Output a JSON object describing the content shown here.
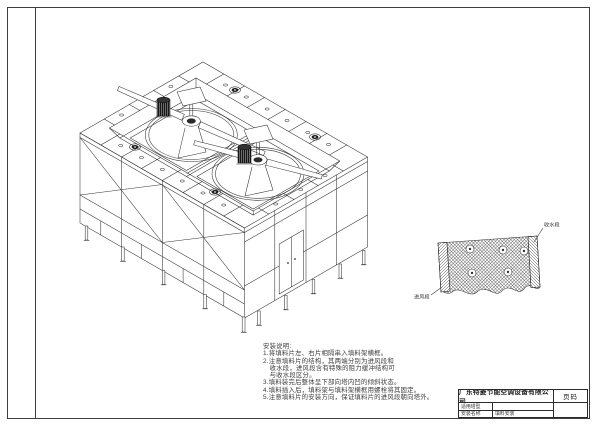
{
  "sheet": {
    "paper_color": "#ffffff",
    "ink_color": "#333333"
  },
  "notes": {
    "title": "安装说明:",
    "lines": [
      "1.将填料片左、右片相隔串入填料架横框。",
      "2.注意填料片的结构，其两端分别为进风段和",
      "　收水段，进风段含有特殊的阻力缓冲结构可",
      "　与收水段区分。",
      "3.填料装完后整体呈下部向塔内凹的倾斜状态。",
      "4.填料插入后，填料架与填料架横框用螺栓将其固定。",
      "5.注意填料片的安装方向，保证填料片的进风段朝向塔外。"
    ]
  },
  "detail": {
    "top_right_label": "收水段",
    "bottom_left_label": "进风段"
  },
  "title_block": {
    "company": "广东特菱节能空调设备有限公司",
    "page_label": "页码",
    "row1_label": "适用塔型",
    "row1_value": "",
    "row2_label": "安装名称",
    "row2_value": "填料安装"
  }
}
